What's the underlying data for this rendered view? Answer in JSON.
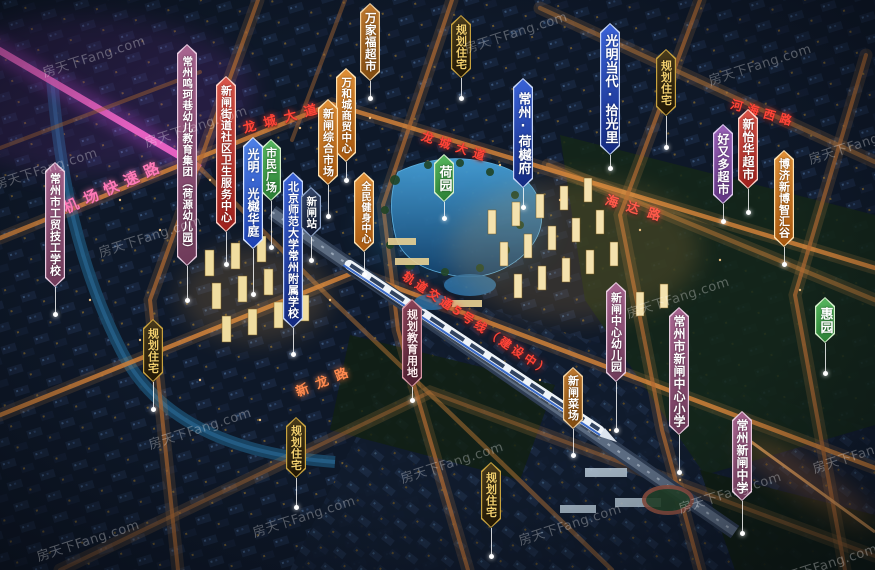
{
  "watermark_text": "房天下Fang.com",
  "palette": {
    "project_blue": "#2f5fd0",
    "deep_blue": "#1c3aa0",
    "green": "#3f9e4a",
    "orange": "#cf7d28",
    "brown": "#a46322",
    "red": "#bf342c",
    "mauve": "#96557f",
    "purple": "#8a55a8",
    "station_dark": "#222f4e",
    "planning_bg": "#332812",
    "planning_text": "#f2cf6e",
    "planning_red": "#6e3349",
    "road_glow": "#e8953f",
    "expressway_pink": "#ff6ad0",
    "road_text_red": "#ff4438",
    "water": "#2a6f9e"
  },
  "banners": [
    {
      "id": "gongmao",
      "text": "常州市工贸技工学校",
      "style": "mauve",
      "x": 55,
      "y": 162,
      "h": 125,
      "stem": 25,
      "size": 11
    },
    {
      "id": "mingke",
      "text": "常州鸣珂巷幼儿教育集团（荷源幼儿园）",
      "style": "mauve",
      "x": 187,
      "y": 44,
      "h": 222,
      "stem": 32,
      "size": 10.5
    },
    {
      "id": "weisheng",
      "text": "新闸街道社区卫生服务中心",
      "style": "red",
      "x": 226,
      "y": 76,
      "h": 156,
      "stem": 30,
      "size": 11
    },
    {
      "id": "shimin",
      "text": "市民广场",
      "style": "green",
      "x": 271,
      "y": 139,
      "h": 62,
      "stem": 44,
      "size": 11
    },
    {
      "id": "guangyuehuating",
      "text": "光明·光樾华庭",
      "style": "blue",
      "x": 253,
      "y": 137,
      "h": 112,
      "stem": 43,
      "size": 12
    },
    {
      "id": "beishida",
      "text": "北京师范大学常州附属学校",
      "style": "deepblue",
      "x": 293,
      "y": 172,
      "h": 156,
      "stem": 24,
      "size": 11
    },
    {
      "id": "xinzhazhan",
      "text": "新闸站",
      "style": "station",
      "x": 311,
      "y": 187,
      "h": 50,
      "stem": 21,
      "size": 10.5
    },
    {
      "id": "wanjiafu",
      "text": "万家福超市",
      "style": "brown",
      "x": 370,
      "y": 3,
      "h": 78,
      "stem": 15,
      "size": 11.5
    },
    {
      "id": "wanhecheng",
      "text": "万和城商贸中心",
      "style": "orange",
      "x": 346,
      "y": 68,
      "h": 94,
      "stem": 16,
      "size": 10.5
    },
    {
      "id": "zongheshichang",
      "text": "新闸综合市场",
      "style": "orange",
      "x": 328,
      "y": 99,
      "h": 86,
      "stem": 29,
      "size": 11
    },
    {
      "id": "quanmin",
      "text": "全民健身中心",
      "style": "orange",
      "x": 364,
      "y": 172,
      "h": 80,
      "stem": 20,
      "size": 10
    },
    {
      "id": "guihuazhuzhai1",
      "text": "规划住宅",
      "style": "plan",
      "x": 461,
      "y": 15,
      "h": 63,
      "stem": 18,
      "size": 11
    },
    {
      "id": "heyuan",
      "text": "荷园",
      "style": "green",
      "x": 444,
      "y": 154,
      "h": 48,
      "stem": 14,
      "size": 13
    },
    {
      "id": "heyuefu",
      "text": "常州·荷樾府",
      "style": "deepblue",
      "x": 523,
      "y": 78,
      "h": 110,
      "stem": 17,
      "size": 13
    },
    {
      "id": "shiguangli",
      "text": "光明当代·拾光里",
      "style": "deepblue",
      "x": 610,
      "y": 23,
      "h": 132,
      "stem": 11,
      "size": 13
    },
    {
      "id": "guihuazhuzhai2",
      "text": "规划住宅",
      "style": "plan",
      "x": 666,
      "y": 49,
      "h": 67,
      "stem": 29,
      "size": 11
    },
    {
      "id": "haoyouduo",
      "text": "好又多超市",
      "style": "purple",
      "x": 723,
      "y": 124,
      "h": 80,
      "stem": 15,
      "size": 12
    },
    {
      "id": "xinyihua",
      "text": "新怡华超市",
      "style": "red",
      "x": 748,
      "y": 109,
      "h": 80,
      "stem": 21,
      "size": 12
    },
    {
      "id": "boji",
      "text": "博济新博智汇谷",
      "style": "orange",
      "x": 784,
      "y": 150,
      "h": 97,
      "stem": 15,
      "size": 11
    },
    {
      "id": "huiyuan",
      "text": "惠园",
      "style": "green",
      "x": 825,
      "y": 297,
      "h": 46,
      "stem": 28,
      "size": 13
    },
    {
      "id": "youeryuan",
      "text": "新闸中心幼儿园",
      "style": "mauve",
      "x": 616,
      "y": 282,
      "h": 100,
      "stem": 46,
      "size": 11
    },
    {
      "id": "xiaoxue",
      "text": "常州市新闸中心小学",
      "style": "mauve",
      "x": 679,
      "y": 307,
      "h": 128,
      "stem": 35,
      "size": 12
    },
    {
      "id": "zhongxue",
      "text": "常州新闸中学",
      "style": "mauve",
      "x": 742,
      "y": 411,
      "h": 90,
      "stem": 30,
      "size": 12
    },
    {
      "id": "caichang",
      "text": "新闸菜场",
      "style": "brown",
      "x": 573,
      "y": 367,
      "h": 62,
      "stem": 24,
      "size": 11
    },
    {
      "id": "jiaoyuyongdi",
      "text": "规划教育用地",
      "style": "planred",
      "x": 412,
      "y": 299,
      "h": 88,
      "stem": 11,
      "size": 11
    },
    {
      "id": "guihuazhuzhai3",
      "text": "规划住宅",
      "style": "plan",
      "x": 153,
      "y": 319,
      "h": 63,
      "stem": 25,
      "size": 11
    },
    {
      "id": "guihuazhuzhai4",
      "text": "规划住宅",
      "style": "plan",
      "x": 296,
      "y": 417,
      "h": 61,
      "stem": 27,
      "size": 11
    },
    {
      "id": "guihuazhuzhai5",
      "text": "规划住宅",
      "style": "plan",
      "x": 491,
      "y": 462,
      "h": 66,
      "stem": 26,
      "size": 11
    }
  ],
  "road_labels": [
    {
      "text": "机场快速路",
      "x": 64,
      "y": 198,
      "rot": -24,
      "size": 15,
      "spacing": 7,
      "color": "#ff7ab8"
    },
    {
      "text": "龙城大道",
      "x": 243,
      "y": 118,
      "rot": -15,
      "size": 13,
      "spacing": 8,
      "color": "#ff4438"
    },
    {
      "text": "龙城大道",
      "x": 422,
      "y": 127,
      "rot": 18,
      "size": 12,
      "spacing": 6,
      "color": "#ff4438"
    },
    {
      "text": "河海西路",
      "x": 731,
      "y": 95,
      "rot": 16,
      "size": 12,
      "spacing": 5,
      "color": "#ff4438"
    },
    {
      "text": "海达路",
      "x": 606,
      "y": 189,
      "rot": 17,
      "size": 13,
      "spacing": 9,
      "color": "#ff5a4a"
    },
    {
      "text": "新龙路",
      "x": 296,
      "y": 382,
      "rot": -22,
      "size": 13,
      "spacing": 8,
      "color": "#ff8a50"
    },
    {
      "text": "轨道交通5号线（建设中）",
      "x": 404,
      "y": 266,
      "rot": 34,
      "size": 12,
      "spacing": 3,
      "color": "#ff4438"
    }
  ],
  "watermarks": [
    {
      "x": 40,
      "y": 46
    },
    {
      "x": 142,
      "y": 116
    },
    {
      "x": -8,
      "y": 158
    },
    {
      "x": 96,
      "y": 226
    },
    {
      "x": 462,
      "y": 22
    },
    {
      "x": 706,
      "y": 54
    },
    {
      "x": 806,
      "y": 133
    },
    {
      "x": 624,
      "y": 287
    },
    {
      "x": 146,
      "y": 418
    },
    {
      "x": 398,
      "y": 452
    },
    {
      "x": 810,
      "y": 442
    },
    {
      "x": 676,
      "y": 482
    },
    {
      "x": 34,
      "y": 530
    },
    {
      "x": 250,
      "y": 506
    },
    {
      "x": 516,
      "y": 514
    },
    {
      "x": 772,
      "y": 554
    }
  ]
}
